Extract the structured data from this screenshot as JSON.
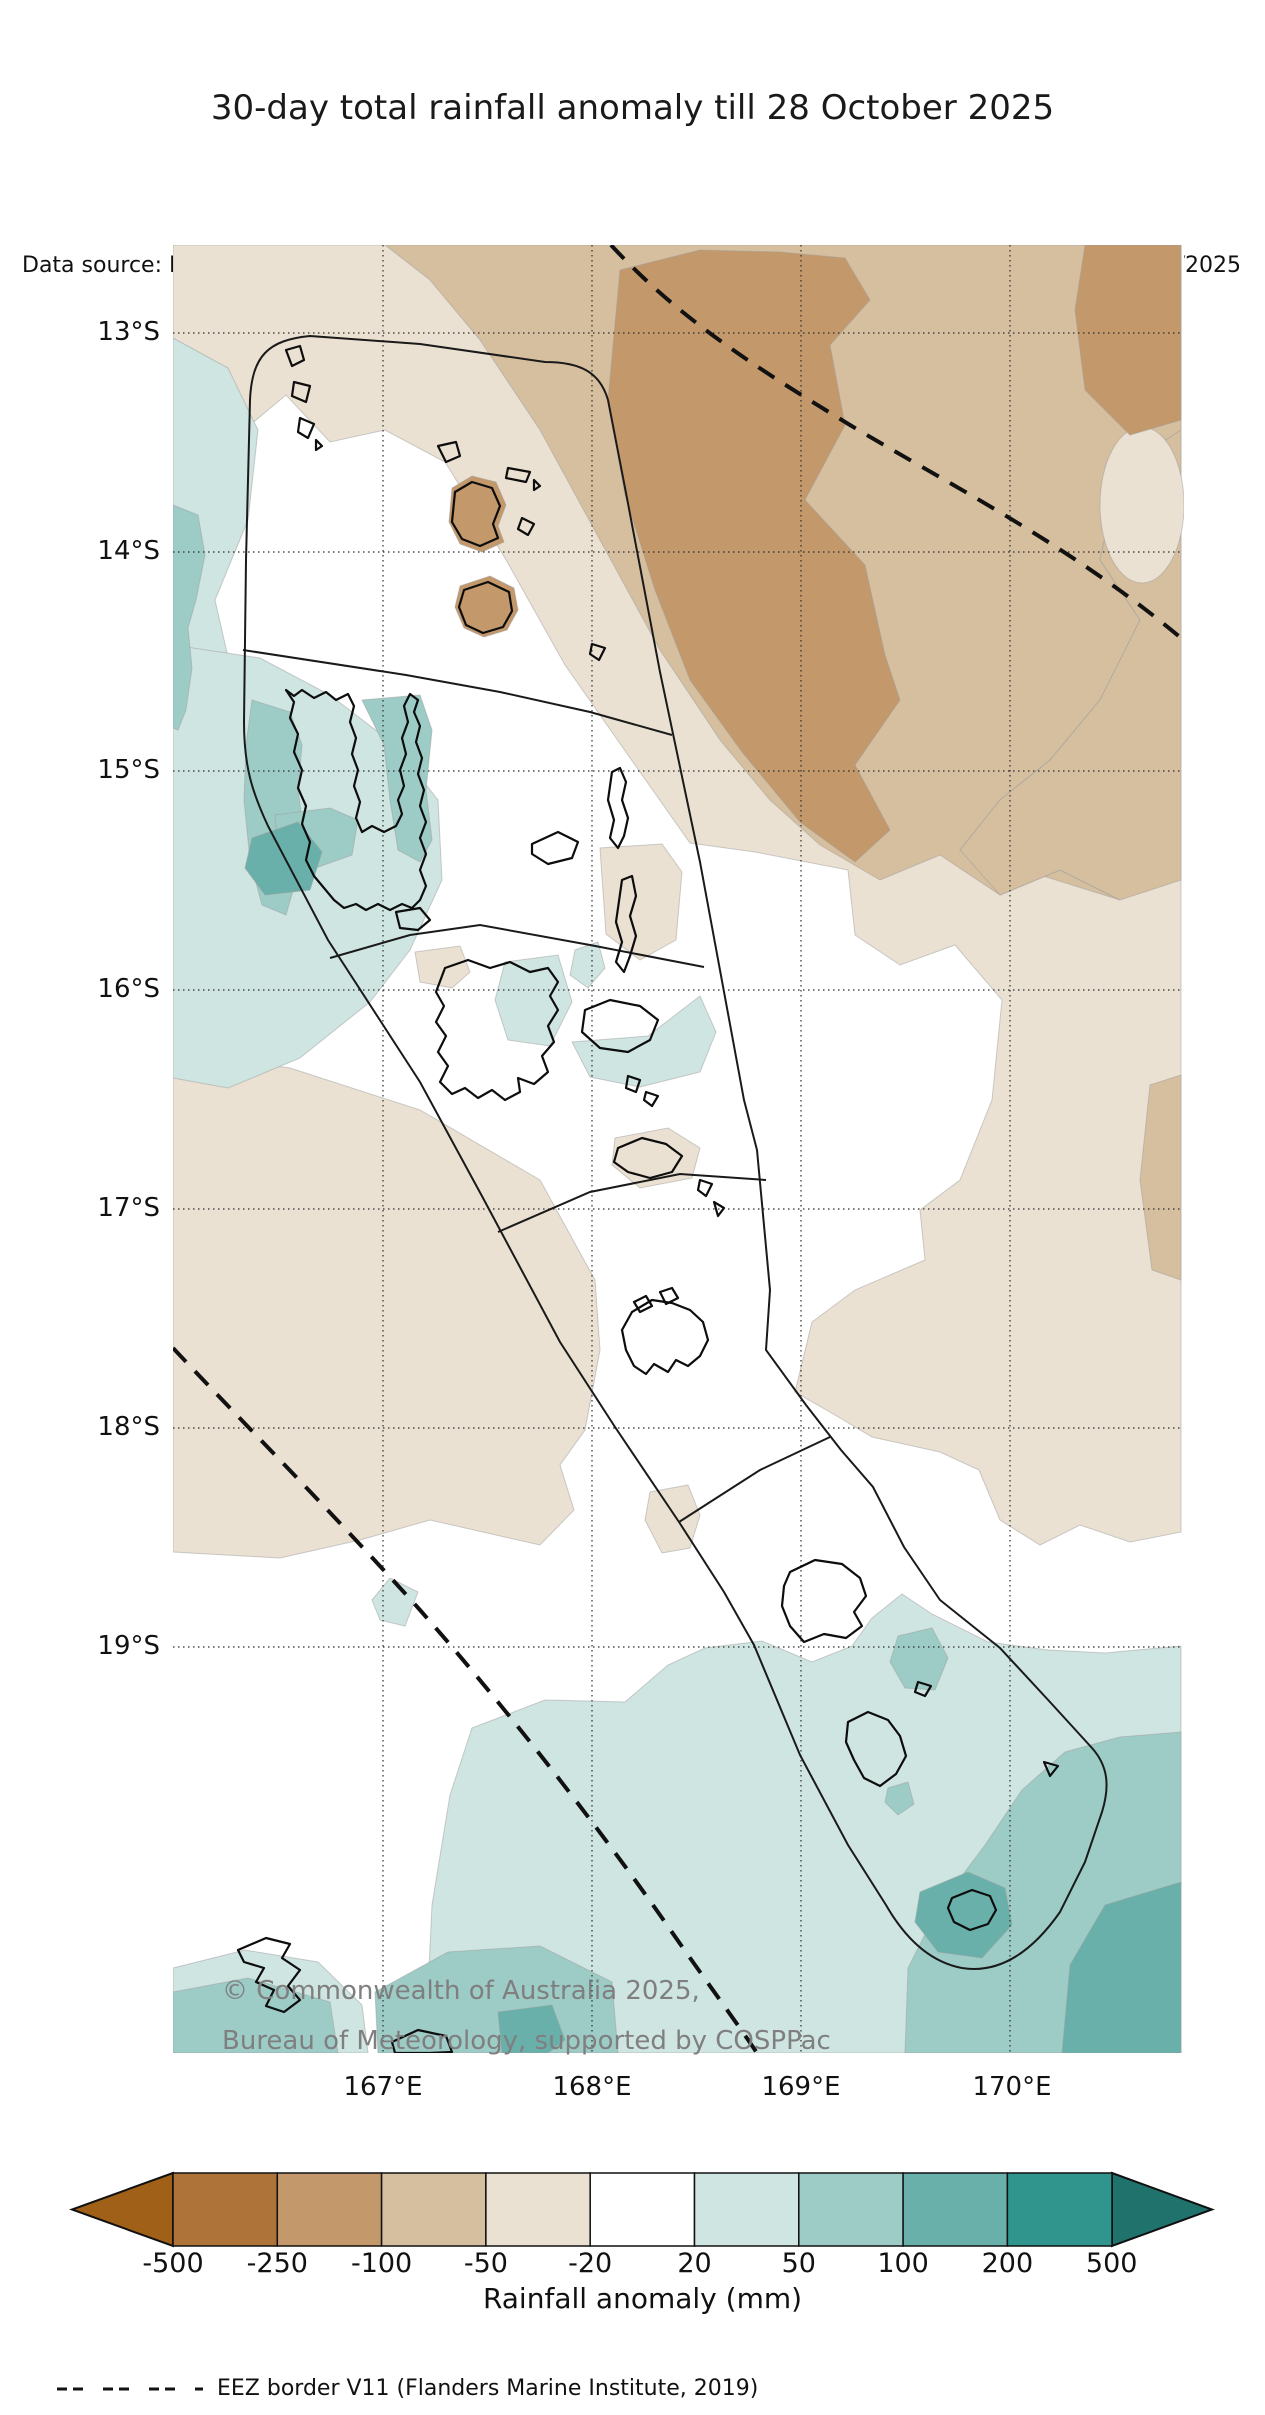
{
  "title": "30-day total rainfall anomaly till 28 October 2025",
  "header": {
    "data_source": "Data source: MSWEP",
    "issued": "Issued: 04/11/2025"
  },
  "map": {
    "copyright_line1": "© Commonwealth of Australia 2025,",
    "copyright_line2": "Bureau of Meteorology, supported by COSPPac",
    "lat_labels": [
      "13°S",
      "14°S",
      "15°S",
      "16°S",
      "17°S",
      "18°S",
      "19°S"
    ],
    "lon_labels": [
      "167°E",
      "168°E",
      "169°E",
      "170°E"
    ]
  },
  "colorbar": {
    "label": "Rainfall anomaly (mm)",
    "tick_values": [
      "-500",
      "-250",
      "-100",
      "-50",
      "-20",
      "20",
      "50",
      "100",
      "200",
      "500"
    ],
    "segment_colors": [
      "#ad7339",
      "#c3986a",
      "#d6bf9f",
      "#ebe1d2",
      "#ffffff",
      "#cfe5e1",
      "#9dccc7",
      "#69b0aa",
      "#2f958d"
    ],
    "arrow_left_color": "#a06018",
    "arrow_right_color": "#20736d"
  },
  "legend": {
    "eez": "EEZ border V11 (Flanders Marine Institute, 2019)"
  },
  "colors": {
    "anom_m250": "#c3986a",
    "anom_m100": "#d6bf9f",
    "anom_m50": "#ebe1d2",
    "anom_p20": "#cfe5e1",
    "anom_p50": "#9dccc7",
    "anom_p100": "#69b0aa",
    "grid": "#2b2b2b",
    "boundary": "#1a1a1a",
    "island": "#0d0d0d",
    "eez_dash": "#111111"
  }
}
